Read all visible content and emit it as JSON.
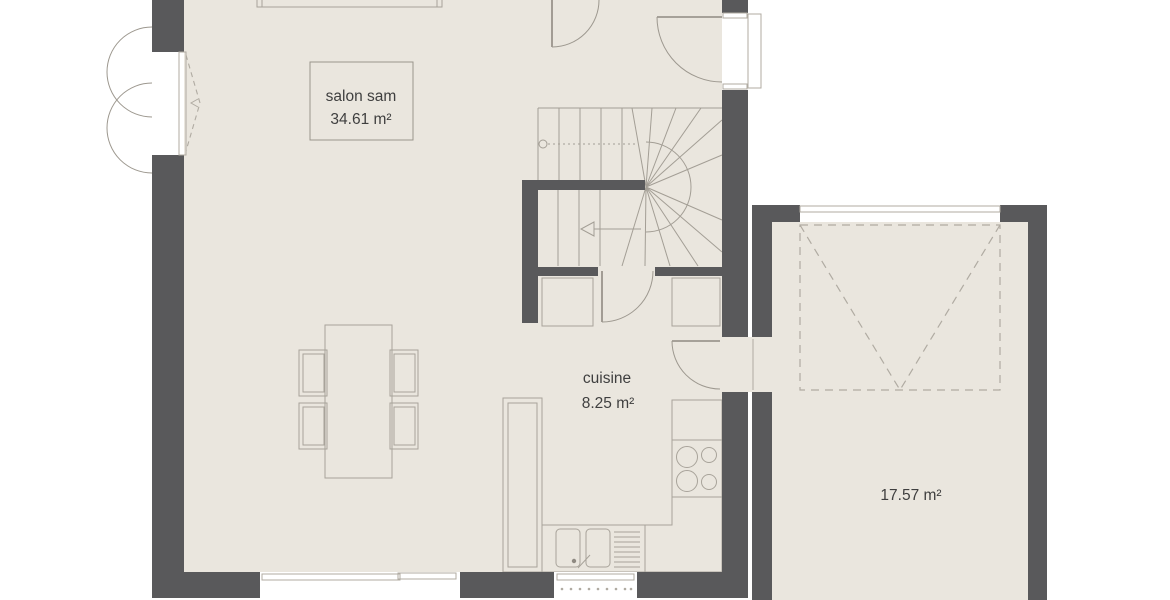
{
  "plan": {
    "type": "floor-plan",
    "rooms": {
      "living": {
        "label": "salon sam",
        "area": "34.61 m²"
      },
      "kitchen": {
        "label": "cuisine",
        "area": "8.25 m²"
      },
      "garage": {
        "area": "17.57 m²"
      }
    },
    "colors": {
      "wall": "#59595b",
      "floor": "#eae6de",
      "fixture_line": "#a8a39a",
      "text": "#3f3f3f",
      "background": "#ffffff"
    },
    "fixtures": [
      "staircase",
      "dining-table",
      "chairs",
      "sideboard",
      "tall-cabinet",
      "kitchen-counter",
      "cooktop",
      "double-sink",
      "drainer",
      "french-door",
      "terrace-door",
      "kitchen-window",
      "entry-door",
      "interior-doors",
      "garage-door",
      "cupboards"
    ]
  }
}
